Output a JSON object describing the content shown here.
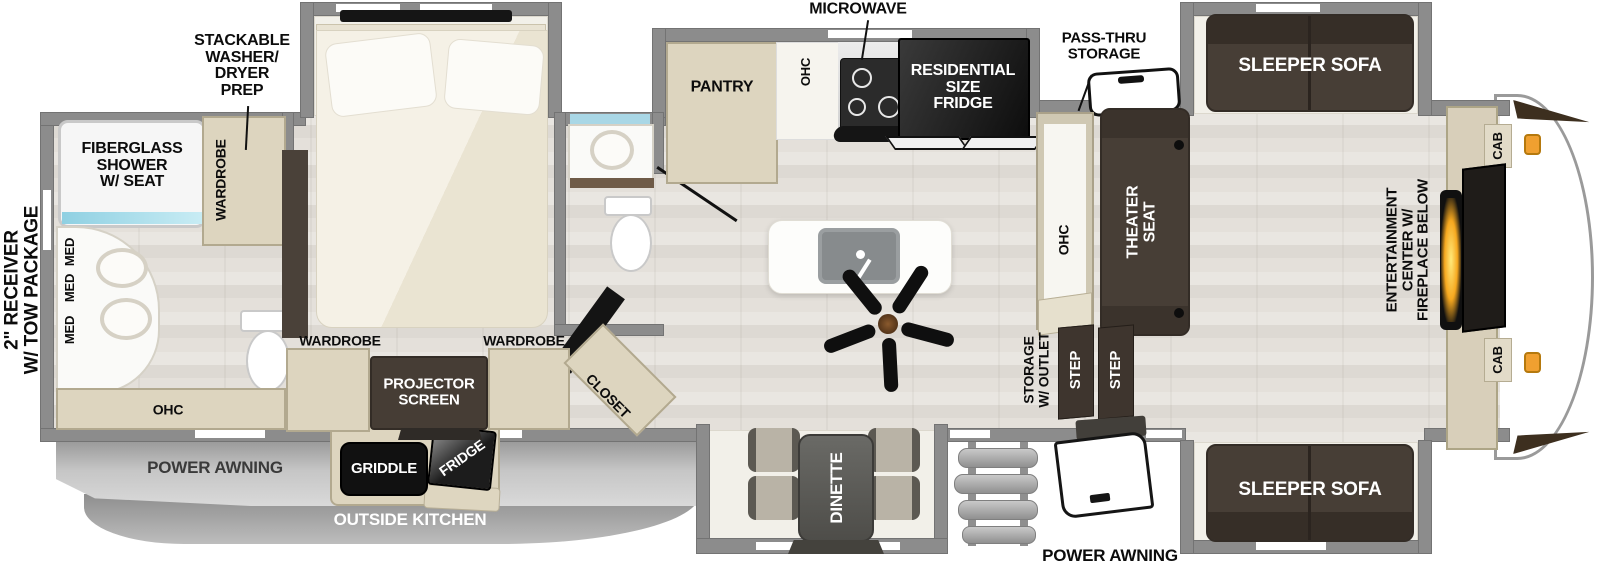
{
  "colors": {
    "wall_gray": "#8c8c8c",
    "cabinet_tan": "#ddd5bf",
    "dark_furniture": "#473e36",
    "appliance_black": "#151515",
    "slide_floor": "#f2f0e9",
    "glass_blue": "#a9d7e6",
    "fireplace_glow": "#f6a81f",
    "awning_gray": "#b5b5b5",
    "marker_orange": "#f0a030"
  },
  "labels": {
    "receiver": "2\" RECEIVER\nW/ TOW PACKAGE",
    "stackable": "STACKABLE\nWASHER/\nDRYER\nPREP",
    "fiberglass": "FIBERGLASS\nSHOWER\nW/ SEAT",
    "wardrobe": "WARDROBE",
    "med": "MED",
    "ohc": "OHC",
    "microwave": "MICROWAVE",
    "pantry": "PANTRY",
    "residential_fridge": "RESIDENTIAL\nSIZE\nFRIDGE",
    "passthru": "PASS-THRU\nSTORAGE",
    "sleeper_sofa": "SLEEPER SOFA",
    "theater_seat": "THEATER\nSEAT",
    "storage_outlet": "STORAGE\nW/ OUTLET",
    "step": "STEP",
    "entertainment": "ENTERTAINMENT\nCENTER W/\nFIREPLACE BELOW",
    "cab": "CAB",
    "projector": "PROJECTOR\nSCREEN",
    "closet": "CLOSET",
    "griddle": "GRIDDLE",
    "fridge_outside": "FRIDGE",
    "dinette": "DINETTE",
    "power_awning": "POWER AWNING",
    "outside_kitchen": "OUTSIDE KITCHEN"
  }
}
